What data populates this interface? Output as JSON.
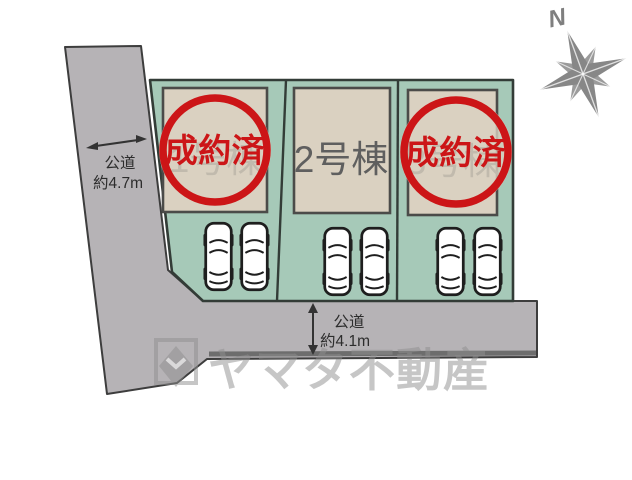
{
  "colors": {
    "road": "#b6b3b6",
    "road_border": "#3d3d3d",
    "road_band": "#6d6d6d",
    "site_green": "#a6c9b8",
    "site_border": "#333c37",
    "building": "#dad1c1",
    "building_border": "#4b4b49",
    "stamp_red": "#cc1517",
    "lot_label_gray": "#5f5f5f",
    "watermark_gray": "#8f8f8f",
    "compass_gray": "#878787"
  },
  "compass": {
    "north_label": "N"
  },
  "roads": {
    "left": {
      "type": "公道",
      "width_label": "約4.7m"
    },
    "bottom": {
      "type": "公道",
      "width_label": "約4.1m"
    }
  },
  "lots": [
    {
      "name": "1号棟",
      "status": "成約済"
    },
    {
      "name": "2号棟"
    },
    {
      "name": "3号棟",
      "status": "成約済"
    }
  ],
  "parking": {
    "cars_per_lot": 2
  },
  "watermark": {
    "company": "ヤマタ不動産"
  }
}
